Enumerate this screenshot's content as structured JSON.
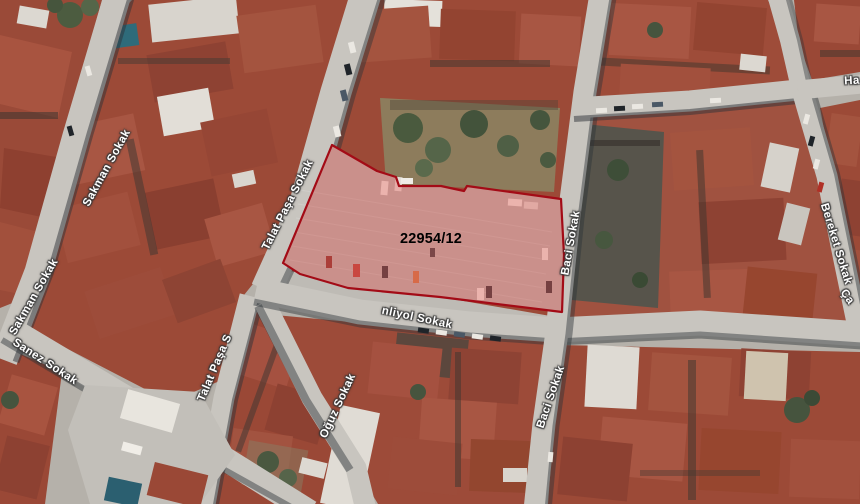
{
  "map": {
    "street_labels": {
      "sakman_upper": "Sakman Sokak",
      "sakman_lower": "Sakman Sokak",
      "sanez": "Sanez Sokak",
      "talat_pasa": "Talat Paşa Sokak",
      "talat_pasa_truncated": "Talat Paşa S",
      "oguz": "Oğuz Sokak",
      "senliyol_truncated": "nliyol Sokak",
      "baci_upper": "Baci Sokak",
      "baci_lower": "Baci Sokak",
      "bereket": "Bereket Sokak",
      "ha_truncated": "Ha",
      "ca_truncated": "Ça"
    },
    "parcel": {
      "number": "22954/12",
      "outline_color": "#a30b16",
      "fill_color": "rgba(236,106,100,0.42)"
    }
  }
}
